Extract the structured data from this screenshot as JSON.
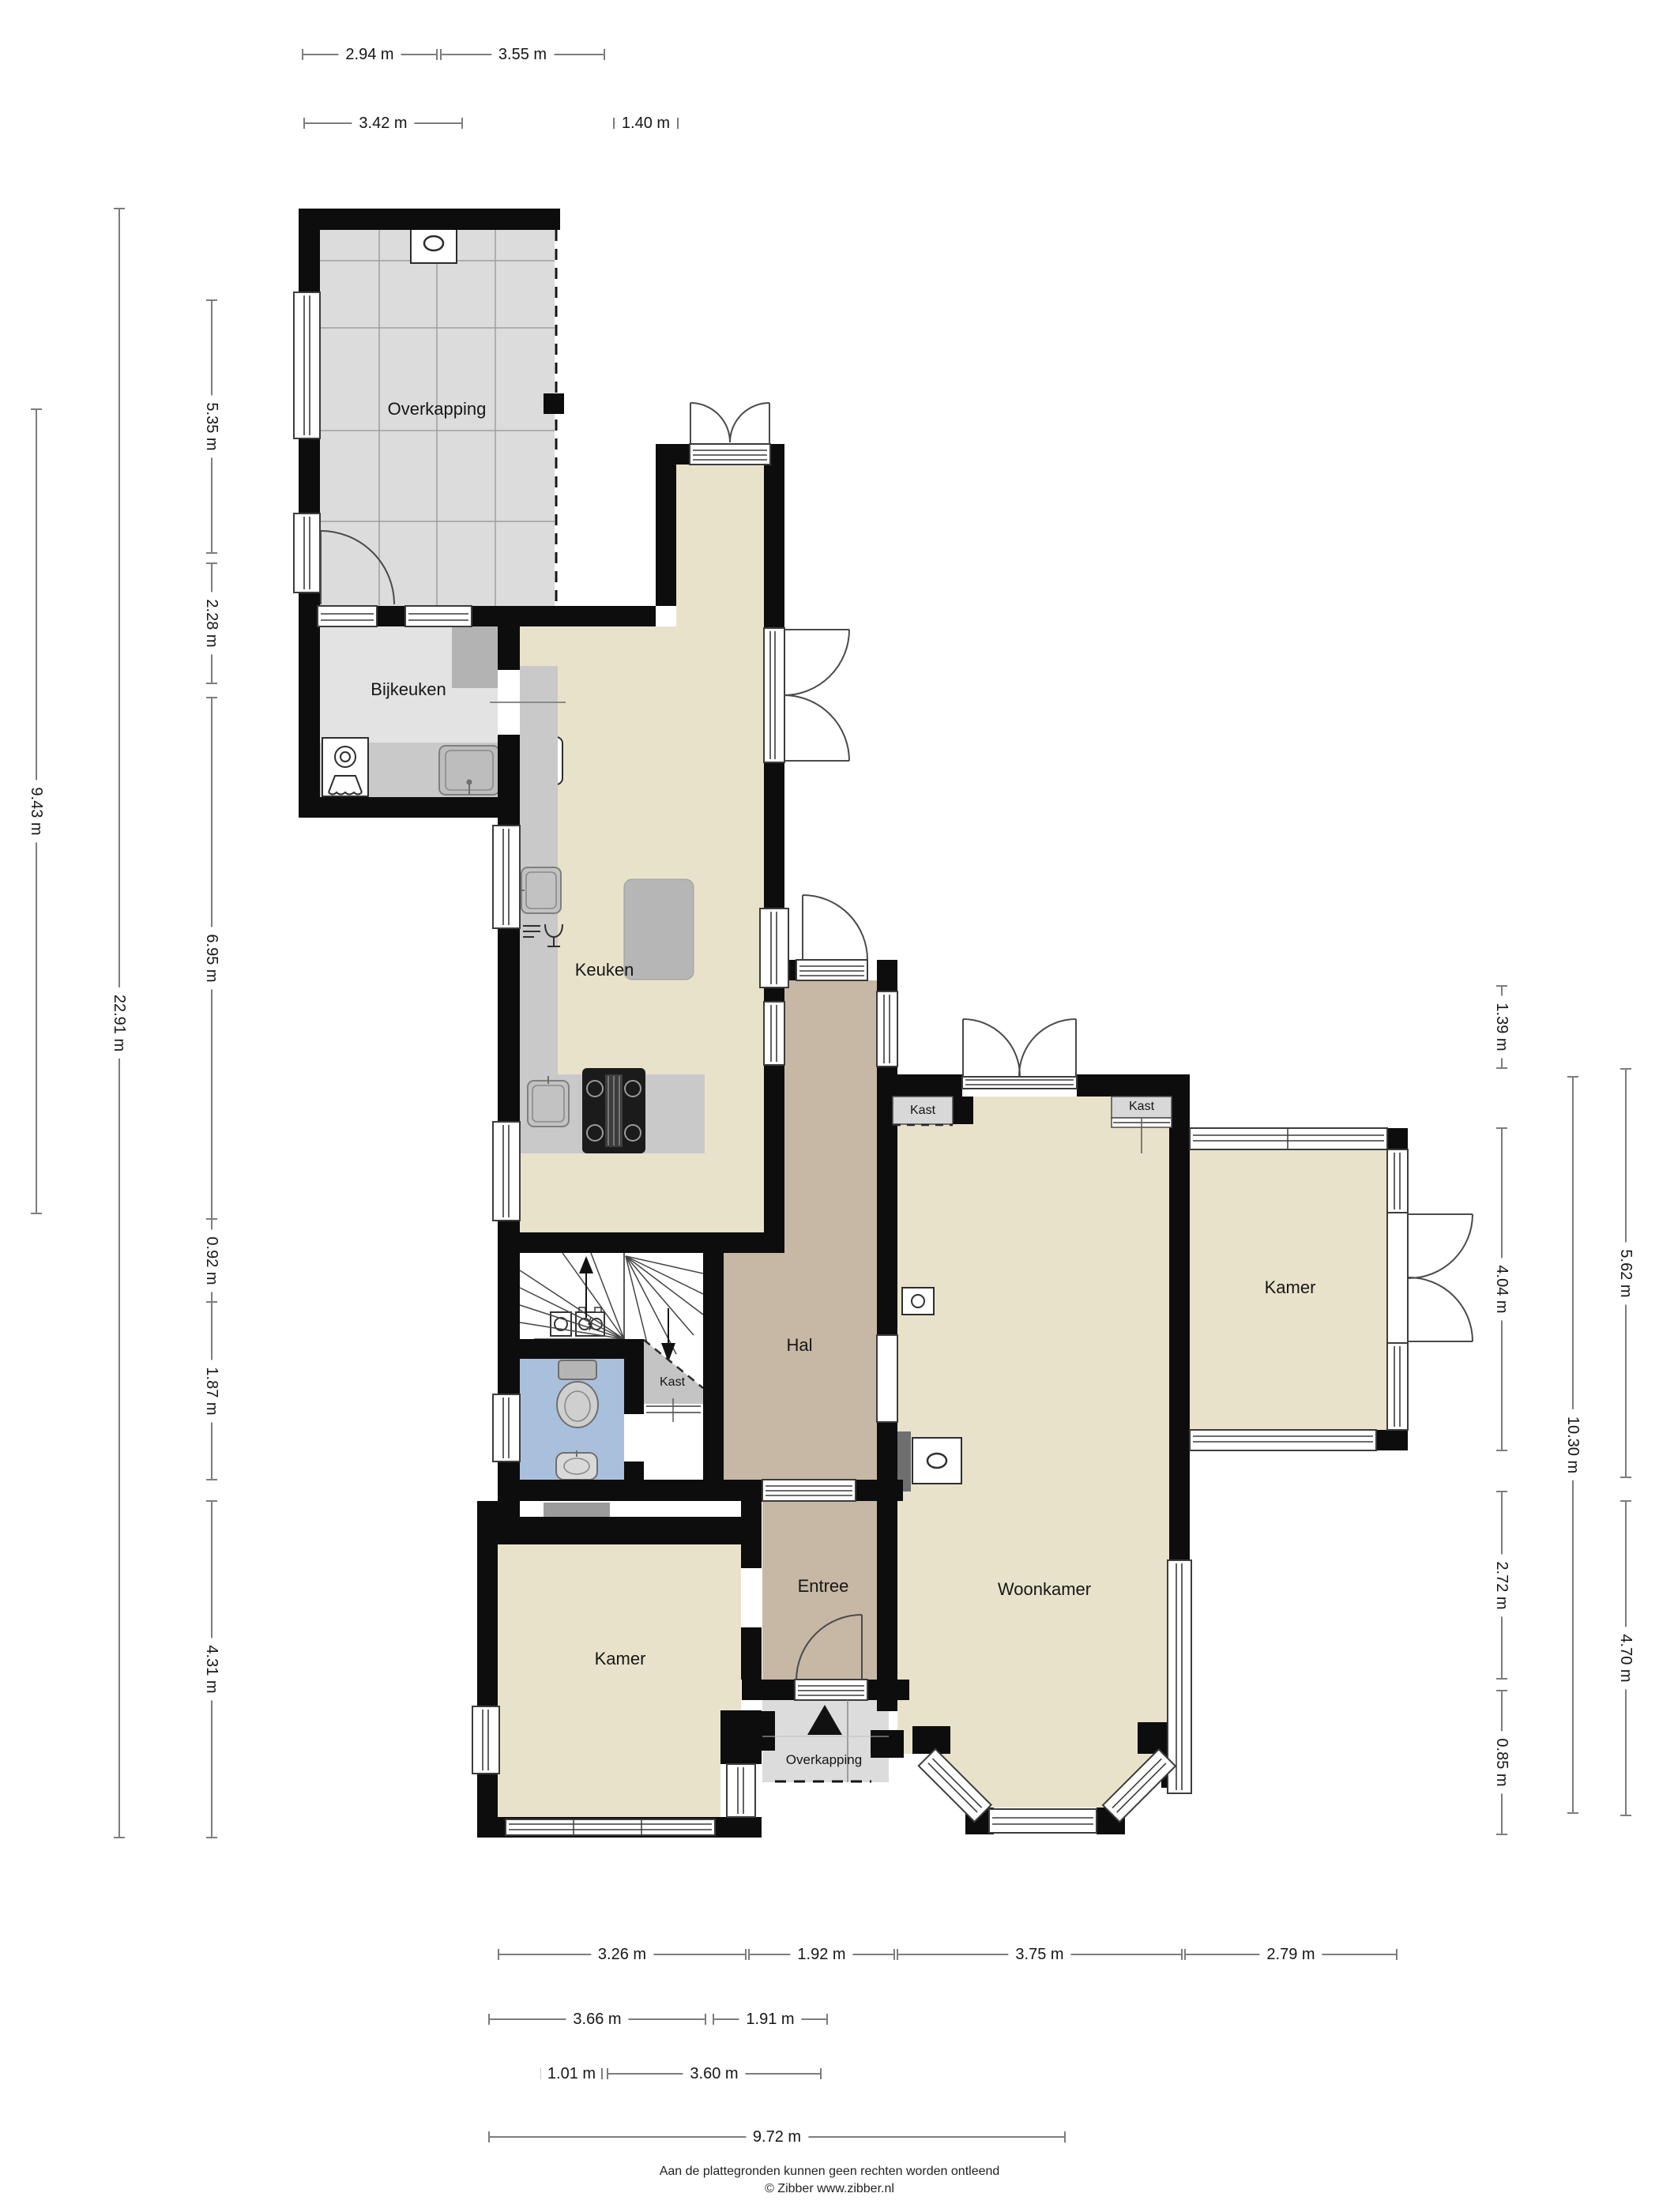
{
  "rooms": {
    "overkapping_top": "Overkapping",
    "bijkeuken": "Bijkeuken",
    "keuken": "Keuken",
    "hal": "Hal",
    "kast_stairs": "Kast",
    "kast_left": "Kast",
    "kast_right": "Kast",
    "kamer_right": "Kamer",
    "woonkamer": "Woonkamer",
    "entree": "Entree",
    "kamer_left": "Kamer",
    "overkapping_bottom": "Overkapping"
  },
  "dimensions": {
    "top": [
      {
        "label": "2.94 m"
      },
      {
        "label": "3.55 m"
      },
      {
        "label": "3.42 m"
      },
      {
        "label": "1.40 m"
      }
    ],
    "left": [
      {
        "label": "9.43 m"
      },
      {
        "label": "22.91 m"
      },
      {
        "label": "5.35 m"
      },
      {
        "label": "2.28 m"
      },
      {
        "label": "6.95 m"
      },
      {
        "label": "0.92 m"
      },
      {
        "label": "1.87 m"
      },
      {
        "label": "4.31 m"
      }
    ],
    "right": [
      {
        "label": "1.39 m"
      },
      {
        "label": "4.04 m"
      },
      {
        "label": "2.72 m"
      },
      {
        "label": "0.85 m"
      },
      {
        "label": "10.30 m"
      },
      {
        "label": "5.62 m"
      },
      {
        "label": "4.70 m"
      }
    ],
    "bottom": [
      {
        "label": "3.26 m"
      },
      {
        "label": "1.92 m"
      },
      {
        "label": "3.75 m"
      },
      {
        "label": "2.79 m"
      },
      {
        "label": "3.66 m"
      },
      {
        "label": "1.91 m"
      },
      {
        "label": "1.01 m"
      },
      {
        "label": "3.60 m"
      },
      {
        "label": "9.72 m"
      }
    ]
  },
  "colors": {
    "room_beige": "#e9e2cb",
    "hall_brown": "#c6b8a5",
    "canopy_gray": "#dcdcdc",
    "utility_gray": "#e3e3e3",
    "counter_gray": "#c9c9c9",
    "toilet_blue": "#a9c0dd",
    "wall_black": "#0d0d0d"
  },
  "footer": {
    "line1": "Aan de plattegronden kunnen geen rechten worden ontleend",
    "line2": "© Zibber www.zibber.nl"
  }
}
